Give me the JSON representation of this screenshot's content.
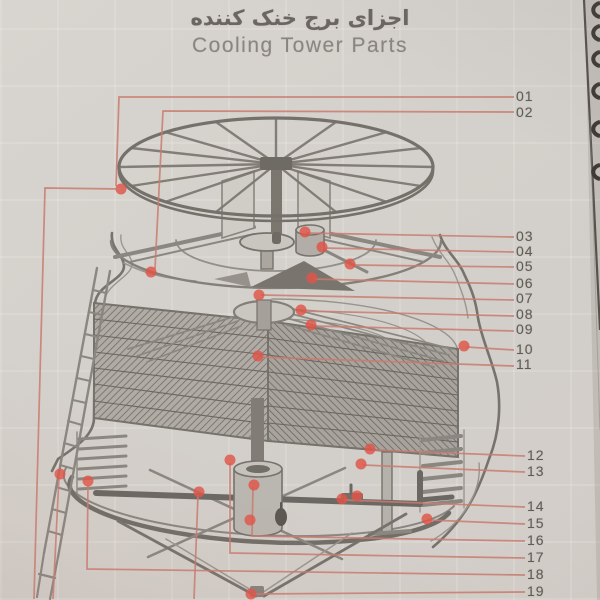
{
  "header": {
    "title_fa": "اجزای برج خنک کننده",
    "title_en": "Cooling Tower Parts"
  },
  "colors": {
    "page_bg": "#d4d0cb",
    "ink": "#76726c",
    "ink_light": "#9a968f",
    "leader_line": "#c97b6f",
    "leader_dot": "#e05448",
    "label_text": "#605c56",
    "page_edge": "#4d4843"
  },
  "diagram": {
    "description": "isometric cutaway of round counterflow cooling tower with numbered part callouts",
    "parts": [
      {
        "num": "01",
        "lx": 516,
        "ly": 96,
        "pts": [
          [
            514,
            97
          ],
          [
            119,
            97
          ],
          [
            116,
            186
          ]
        ],
        "dots": [
          [
            121,
            189
          ]
        ]
      },
      {
        "num": "02",
        "lx": 516,
        "ly": 112,
        "pts": [
          [
            514,
            112
          ],
          [
            163,
            111
          ],
          [
            155,
            269
          ]
        ],
        "dots": [
          [
            151,
            272
          ]
        ]
      },
      {
        "num": "03",
        "lx": 516,
        "ly": 236,
        "pts": [
          [
            514,
            237
          ],
          [
            306,
            233
          ]
        ],
        "dots": [
          [
            305,
            232
          ]
        ]
      },
      {
        "num": "04",
        "lx": 516,
        "ly": 251,
        "pts": [
          [
            514,
            252
          ],
          [
            323,
            248
          ]
        ],
        "dots": [
          [
            322,
            247
          ]
        ]
      },
      {
        "num": "05",
        "lx": 516,
        "ly": 266,
        "pts": [
          [
            514,
            267
          ],
          [
            352,
            265
          ]
        ],
        "dots": [
          [
            350,
            264
          ]
        ]
      },
      {
        "num": "06",
        "lx": 516,
        "ly": 283,
        "pts": [
          [
            514,
            284
          ],
          [
            314,
            279
          ]
        ],
        "dots": [
          [
            312,
            278
          ]
        ]
      },
      {
        "num": "07",
        "lx": 516,
        "ly": 298,
        "pts": [
          [
            514,
            300
          ],
          [
            261,
            295
          ]
        ],
        "dots": [
          [
            259,
            295
          ]
        ]
      },
      {
        "num": "08",
        "lx": 516,
        "ly": 314,
        "pts": [
          [
            514,
            316
          ],
          [
            303,
            311
          ]
        ],
        "dots": [
          [
            301,
            310
          ]
        ]
      },
      {
        "num": "09",
        "lx": 516,
        "ly": 329,
        "pts": [
          [
            514,
            331
          ],
          [
            313,
            326
          ]
        ],
        "dots": [
          [
            311,
            325
          ]
        ]
      },
      {
        "num": "10",
        "lx": 516,
        "ly": 349,
        "pts": [
          [
            514,
            350
          ],
          [
            466,
            347
          ]
        ],
        "dots": [
          [
            464,
            346
          ]
        ]
      },
      {
        "num": "11",
        "lx": 516,
        "ly": 364,
        "pts": [
          [
            514,
            366
          ],
          [
            260,
            357
          ]
        ],
        "dots": [
          [
            258,
            356
          ]
        ]
      },
      {
        "num": "12",
        "lx": 527,
        "ly": 455,
        "pts": [
          [
            525,
            456
          ],
          [
            372,
            450
          ]
        ],
        "dots": [
          [
            370,
            449
          ]
        ]
      },
      {
        "num": "13",
        "lx": 527,
        "ly": 471,
        "pts": [
          [
            525,
            472
          ],
          [
            363,
            465
          ]
        ],
        "dots": [
          [
            361,
            464
          ]
        ]
      },
      {
        "num": "14",
        "lx": 527,
        "ly": 506,
        "pts": [
          [
            525,
            507
          ],
          [
            344,
            500
          ]
        ],
        "dots": [
          [
            342,
            499
          ],
          [
            357,
            496
          ]
        ]
      },
      {
        "num": "15",
        "lx": 527,
        "ly": 523,
        "pts": [
          [
            525,
            524
          ],
          [
            429,
            520
          ]
        ],
        "dots": [
          [
            427,
            519
          ]
        ]
      },
      {
        "num": "16",
        "lx": 527,
        "ly": 540,
        "pts": [
          [
            525,
            541
          ],
          [
            252,
            536
          ],
          [
            253,
            487
          ]
        ],
        "dots": [
          [
            254,
            485
          ],
          [
            250,
            520
          ]
        ]
      },
      {
        "num": "17",
        "lx": 527,
        "ly": 557,
        "pts": [
          [
            525,
            558
          ],
          [
            230,
            553
          ],
          [
            230,
            463
          ]
        ],
        "dots": [
          [
            230,
            460
          ]
        ]
      },
      {
        "num": "18",
        "lx": 527,
        "ly": 574,
        "pts": [
          [
            525,
            575
          ],
          [
            87,
            569
          ],
          [
            88,
            485
          ]
        ],
        "dots": [
          [
            88,
            481
          ]
        ]
      },
      {
        "num": "19",
        "lx": 527,
        "ly": 591,
        "pts": [
          [
            525,
            592
          ],
          [
            254,
            594
          ]
        ],
        "dots": [
          [
            251,
            594
          ]
        ]
      }
    ],
    "extra_leaders": [
      {
        "pts": [
          [
            121,
            189
          ],
          [
            45,
            188
          ],
          [
            34,
            599
          ]
        ],
        "dots": []
      },
      {
        "pts": [
          [
            59,
            477
          ],
          [
            53,
            599
          ]
        ],
        "dots": [
          [
            60,
            474
          ]
        ]
      },
      {
        "pts": [
          [
            198,
            495
          ],
          [
            194,
            599
          ]
        ],
        "dots": [
          [
            199,
            492
          ]
        ]
      }
    ]
  }
}
